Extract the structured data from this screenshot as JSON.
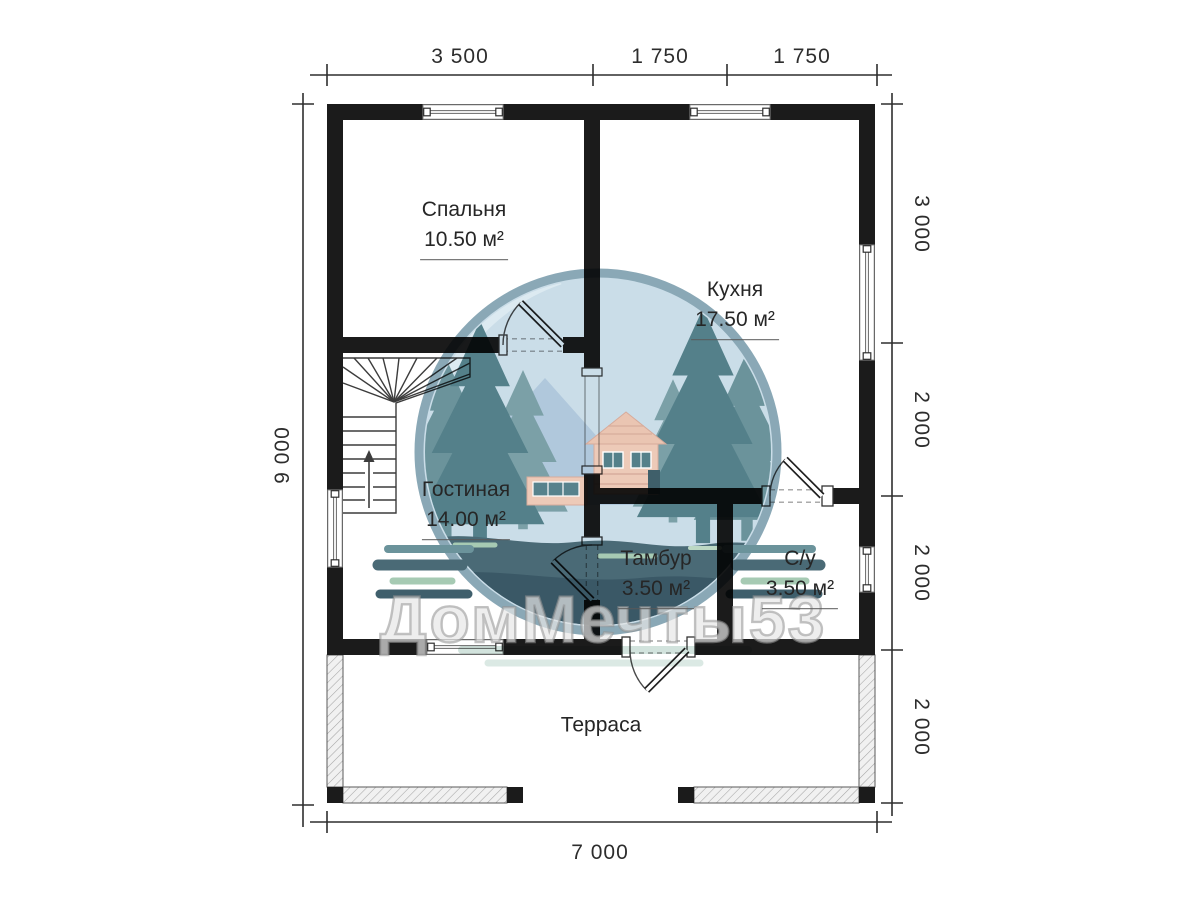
{
  "watermark": {
    "text": "ДомМечты53"
  },
  "rooms": [
    {
      "name": "Спальня",
      "area": "10.50 м²"
    },
    {
      "name": "Кухня",
      "area": "17.50 м²"
    },
    {
      "name": "Гостиная",
      "area": "14.00 м²"
    },
    {
      "name": "Тамбур",
      "area": "3.50 м²"
    },
    {
      "name": "С/у",
      "area": "3.50 м²"
    },
    {
      "name": "Терраса",
      "area": ""
    }
  ],
  "dimensions": {
    "top": [
      "3 500",
      "1 750",
      "1 750"
    ],
    "right": [
      "3 000",
      "2 000",
      "2 000",
      "2 000"
    ],
    "left": [
      "9 000"
    ],
    "bottom": [
      "7 000"
    ]
  },
  "colors": {
    "wall": "#1b1b1b",
    "line": "#3c3c3c",
    "dimension": "#2e2e2e",
    "hatch_fill": "#f1f1f1",
    "logo_sky": "#cadde8",
    "logo_ring": "#8aa8b6",
    "logo_tree_dark": "#54808a",
    "logo_navy": "#3a5866",
    "logo_ground": "#4a6a76",
    "logo_house": "#edcab8",
    "logo_green": "#a6cab3"
  }
}
